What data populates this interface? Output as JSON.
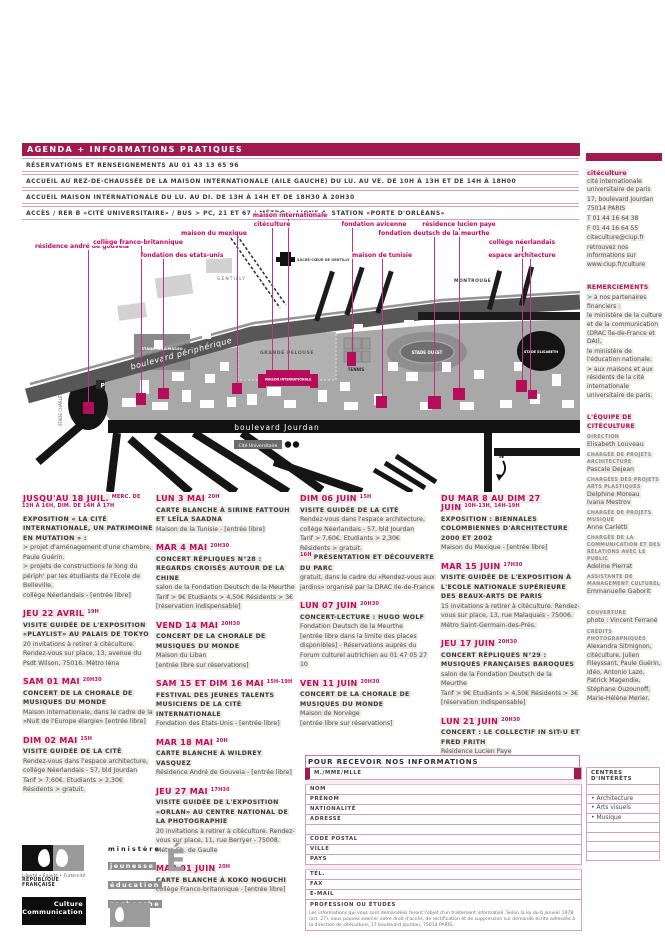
{
  "header": {
    "title": "AGENDA + INFORMATIONS PRATIQUES",
    "info_lines": [
      "RÉSERVATIONS ET RENSEIGNEMENTS AU 01 43 13 65 96",
      "ACCUEIL AU REZ-DE-CHAUSSÉE DE LA MAISON INTERNATIONALE (AILE GAUCHE) DU LU. AU VE. DE 10H À 13H ET DE 14H À 18H00",
      "ACCUEIL MAISON INTERNATIONALE DU LU. AU DI. DE 13H À 14H ET DE 18H30 À 20H30",
      "ACCÈS / RER B «CITÉ UNIVERSITAIRE» / BUS > PC, 21 ET 67 / MÉTRO > LIGNE 4, STATION «PORTE D'ORLÉANS»"
    ]
  },
  "map": {
    "labels": [
      "résidence andré de gouveia",
      "collège franco-britannique",
      "fondation des etats-unis",
      "maison du mexique",
      "maison internationale",
      "citéculture",
      "fondation avicenne",
      "fondation deutsch de la meurthe",
      "résidence lucien paye",
      "maison de tunisie",
      "collège néerlandais",
      "espace architecture"
    ],
    "roads": {
      "peripherique": "boulevard périphérique",
      "jourdan": "boulevard Jourdan"
    },
    "places": {
      "gentilly": "GENTILLY",
      "montrouge": "MONTROUGE",
      "sacre_coeur": "SACRÉ-CŒUR DE GENTILLY",
      "grande_pelouse": "GRANDE PELOUSE",
      "tennis": "TENNIS",
      "stade_ouest": "STADE OUEST",
      "stade_elisabeth": "STADE ELISABETH",
      "stade_chalmasso": "STADE CHALMASSO",
      "stade_charlety": "STADE CHARLÉTY",
      "cite_universitaire": "Cité Universitaire",
      "maison_internationale": "MAISON INTERNATIONALE",
      "parking": "P",
      "north": "N"
    }
  },
  "events": {
    "columns": [
      [
        {
          "date": "JUSQU'AU 18 JUIL.",
          "time": "MERC. DE 13H À 16H, DIM. DE 14H À 17H",
          "lines": [
            {
              "k": "t",
              "t": "EXPOSITION « LA CITÉ INTERNATIONALE, UN PATRIMOINE EN MUTATION » :"
            },
            {
              "k": "b",
              "t": "> projet d'aménagement d'une chambre, Paule Guérin."
            },
            {
              "k": "b",
              "t": "> projets de constructions le long du périph' par les étudiants de l'Ecole de Belleville."
            },
            {
              "k": "b",
              "t": "collège Néerlandais - [entrée libre]"
            }
          ]
        },
        {
          "date": "JEU 22 AVRIL",
          "time": "19H",
          "lines": [
            {
              "k": "t",
              "t": "VISITE GUIDÉE DE L'EXPOSITION «PLAYLIST» AU PALAIS DE TOKYO"
            },
            {
              "k": "b",
              "t": "20 invitations à retirer à citéculture. Rendez-vous sur place, 13, avenue du Psdt Wilson, 75016. Métro Iéna"
            }
          ]
        },
        {
          "date": "SAM 01 MAI",
          "time": "20H30",
          "lines": [
            {
              "k": "t",
              "t": "CONCERT DE LA CHORALE DE MUSIQUES DU MONDE"
            },
            {
              "k": "b",
              "t": "Maison internationale, dans le cadre de la «Nuit de l'Europe élargie» [entrée libre]"
            }
          ]
        },
        {
          "date": "DIM 02 MAI",
          "time": "15H",
          "lines": [
            {
              "k": "t",
              "t": "VISITE GUIDÉE DE LA CITÉ"
            },
            {
              "k": "b",
              "t": "Rendez-vous dans l'espace architecture, collège Néerlandais - 57, bld Jourdan"
            },
            {
              "k": "b",
              "t": "Tarif > 7,60€. Etudiants > 2,30€"
            },
            {
              "k": "b",
              "t": "Résidents > gratuit."
            }
          ]
        }
      ],
      [
        {
          "date": "LUN 3 MAI",
          "time": "20H",
          "lines": [
            {
              "k": "t",
              "t": "CARTE BLANCHE À SIRINE FATTOUH ET LEÏLA SAADNA"
            },
            {
              "k": "b",
              "t": "Maison de la Tunisie - [entrée libre]"
            }
          ]
        },
        {
          "date": "MAR 4 MAI",
          "time": "20H30",
          "lines": [
            {
              "k": "t",
              "t": "CONCERT RÉPLIQUES N°28 : REGARDS CROISÉS AUTOUR DE LA CHINE"
            },
            {
              "k": "b",
              "t": "salon de la Fondation Deutsch de la Meurthe"
            },
            {
              "k": "b",
              "t": "Tarif > 9€ Etudiants > 4,50€ Résidents > 3€"
            },
            {
              "k": "b",
              "t": "[réservation indispensable]"
            }
          ]
        },
        {
          "date": "VEND 14 MAI",
          "time": "20H30",
          "lines": [
            {
              "k": "t",
              "t": "CONCERT DE LA CHORALE DE MUSIQUES DU MONDE"
            },
            {
              "k": "b",
              "t": "Maison du Liban"
            },
            {
              "k": "b",
              "t": "[entrée libre sur réservations]"
            }
          ]
        },
        {
          "date": "SAM 15 ET DIM 16 MAI",
          "time": "15H-19H",
          "lines": [
            {
              "k": "t",
              "t": "FESTIVAL DES JEUNES TALENTS MUSICIENS DE LA CITÉ INTERNATIONALE"
            },
            {
              "k": "b",
              "t": "Fondation des Etats-Unis - [entrée libre]"
            }
          ]
        },
        {
          "date": "MAR 18 MAI",
          "time": "20H",
          "lines": [
            {
              "k": "t",
              "t": "CARTE BLANCHE À WILDREY VASQUEZ"
            },
            {
              "k": "b",
              "t": "Résidence André de Gouveia - [entrée libre]"
            }
          ]
        },
        {
          "date": "JEU 27 MAI",
          "time": "17H30",
          "lines": [
            {
              "k": "t",
              "t": "VISITE GUIDÉE DE L'EXPOSITION «ORLAN» AU CENTRE NATIONAL DE LA PHOTOGRAPHIE"
            },
            {
              "k": "b",
              "t": "20 invitations à retirer à citéculture. Rendez-vous sur place, 11, rue Berryer - 75008. Métro Ch. de Gaulle"
            }
          ]
        },
        {
          "date": "MAR 01 JUIN",
          "time": "20H",
          "lines": [
            {
              "k": "t",
              "t": "CARTE BLANCHE À KOKO NOGUCHI"
            },
            {
              "k": "b",
              "t": "collège Franco-britannique - [entrée libre]"
            }
          ]
        }
      ],
      [
        {
          "date": "DIM 06 JUIN",
          "time": "15H",
          "lines": [
            {
              "k": "t",
              "t": "VISITE GUIDÉE DE LA CITÉ"
            },
            {
              "k": "b",
              "t": "Rendez-vous dans l'espace architecture, collège Néerlandais - 57, bld Jourdan"
            },
            {
              "k": "b",
              "t": "Tarif > 7,60€. Etudiants > 2,30€"
            },
            {
              "k": "b",
              "t": "Résidents > gratuit."
            },
            {
              "k": "t",
              "sup": "16H",
              "t": "PRÉSENTATION ET DÉCOUVERTE DU PARC"
            },
            {
              "k": "b",
              "t": "gratuit, dans le cadre du «Rendez-vous aux jardins» organisé par la DRAC Ile-de-France"
            }
          ]
        },
        {
          "date": "LUN 07 JUIN",
          "time": "20H30",
          "lines": [
            {
              "k": "t",
              "t": "CONCERT-LECTURE : HUGO WOLF"
            },
            {
              "k": "b",
              "t": "Fondation Deutsch de la Meurthe"
            },
            {
              "k": "b",
              "t": "[entrée libre dans la limite des places disponibles] - Réservations auprès du Forum culturel autrichien au 01 47 05 27 10"
            }
          ]
        },
        {
          "date": "VEN 11 JUIN",
          "time": "20H30",
          "lines": [
            {
              "k": "t",
              "t": "CONCERT DE LA CHORALE DE MUSIQUES DU MONDE"
            },
            {
              "k": "b",
              "t": "Maison de Norvège"
            },
            {
              "k": "b",
              "t": "[entrée libre sur réservations]"
            }
          ]
        }
      ],
      [
        {
          "date": "DU MAR 8 AU DIM 27 JUIN",
          "time": "10H-13H, 14H-19H",
          "lines": [
            {
              "k": "t",
              "t": "EXPOSITION : BIENNALES COLOMBIENNES D'ARCHITECTURE 2000 ET 2002"
            },
            {
              "k": "b",
              "t": "Maison du Mexique - [entrée libre]"
            }
          ]
        },
        {
          "date": "MAR 15 JUIN",
          "time": "17H30",
          "lines": [
            {
              "k": "t",
              "t": "VISITE GUIDÉE DE L'EXPOSITION À L'ECOLE NATIONALE SUPÉRIEURE DES BEAUX-ARTS DE PARIS"
            },
            {
              "k": "b",
              "t": "15 invitations à retirer à citéculture. Rendez-vous sur place, 13, rue Malaquais - 75006. Métro Saint-Germain-des-Prés."
            }
          ]
        },
        {
          "date": "JEU 17 JUIN",
          "time": "20H30",
          "lines": [
            {
              "k": "t",
              "t": "CONCERT RÉPLIQUES N°29 : MUSIQUES FRANÇAISES BAROQUES"
            },
            {
              "k": "b",
              "t": "salon de la Fondation Deutsch de la Meurthe"
            },
            {
              "k": "b",
              "t": "Tarif > 9€ Etudiants > 4,50€ Résidents > 3€"
            },
            {
              "k": "b",
              "t": "[réservation indispensable]"
            }
          ]
        },
        {
          "date": "LUN 21 JUIN",
          "time": "20H30",
          "lines": [
            {
              "k": "t",
              "t": "CONCERT : LE COLLECTIF IN SIT-U ET FRED FRITH"
            },
            {
              "k": "b",
              "t": "Résidence Lucien Paye"
            },
            {
              "k": "b",
              "t": "[entrée libre]"
            }
          ]
        }
      ]
    ]
  },
  "sidebar": {
    "blocks": [
      {
        "head": null,
        "lines": [
          {
            "s": "brand",
            "t": "citéculture"
          },
          {
            "s": "text",
            "t": "cité internationale universitaire de paris"
          },
          {
            "s": "text",
            "t": "17, boulevard Jourdan"
          },
          {
            "s": "text",
            "t": "75014 PARIS"
          },
          {
            "s": "text",
            "t": "T 01 44 16 64 38"
          },
          {
            "s": "text",
            "t": "F 01 44 16 64 55"
          },
          {
            "s": "text",
            "t": "citeculture@ciup.fr"
          },
          {
            "s": "text",
            "t": "retrouvez nos informations sur www.ciup.fr/culture"
          }
        ]
      },
      {
        "head": "REMERCIEMENTS",
        "lines": [
          {
            "s": "text",
            "t": "> à nos partenaires financiers :"
          },
          {
            "s": "text",
            "t": "le ministère de la culture et de la communication (DRAC île-de-France et DAI),"
          },
          {
            "s": "text",
            "t": "le ministère de l'éducation nationale."
          },
          {
            "s": "text",
            "t": "> aux maisons et aux résidents de la cité internationale universitaire de paris."
          }
        ]
      },
      {
        "head": "L'ÉQUIPE DE CITÉCULTURE",
        "lines": [
          {
            "s": "role",
            "t": "DIRECTION"
          },
          {
            "s": "name",
            "t": "Elisabeth Louveau"
          },
          {
            "s": "role",
            "t": "CHARGÉE DE PROJETS ARCHITECTURE"
          },
          {
            "s": "name",
            "t": "Pascale Dejean"
          },
          {
            "s": "role",
            "t": "CHARGÉES DES PROJETS ARTS PLASTIQUES"
          },
          {
            "s": "name",
            "t": "Delphine Moreau"
          },
          {
            "s": "name",
            "t": "Ivana Mestrov"
          },
          {
            "s": "role",
            "t": "CHARGÉE DE PROJETS MUSIQUE"
          },
          {
            "s": "name",
            "t": "Anne Carletti"
          },
          {
            "s": "role",
            "t": "CHARGÉE DE LA COMMUNICATION ET DES RELATIONS AVEC LE PUBLIC"
          },
          {
            "s": "name",
            "t": "Adeline Pierrat"
          },
          {
            "s": "role",
            "t": "ASSISTANTE DE MANAGEMENT CULTUREL"
          },
          {
            "s": "name",
            "t": "Emmanuelle Gaborit"
          }
        ]
      },
      {
        "head": null,
        "lines": [
          {
            "s": "role",
            "t": "COUVERTURE"
          },
          {
            "s": "text",
            "t": "photo : Vincent Ferrané"
          },
          {
            "s": "role",
            "t": "CRÉDITS PHOTOGRAPHIQUES"
          },
          {
            "s": "text",
            "t": "Alexandra Sitmignon, citéculture, Julien Fileyssant, Paule Guérin, Idéo, Antonio Lazo, Patrick Magendie, Stéphane Ouzounoff, Marie-Hélène Merier."
          }
        ]
      }
    ]
  },
  "form": {
    "title": "POUR RECEVOIR NOS INFORMATIONS",
    "fields": [
      "M./MME/MLLE",
      "NOM",
      "PRÉNOM",
      "NATIONALITÉ",
      "ADRESSE",
      "CODE POSTAL",
      "VILLE",
      "PAYS",
      "TÉL.",
      "FAX",
      "E-MAIL",
      "PROFESSION OU ÉTUDES"
    ],
    "centres": {
      "title": "CENTRES D'INTÉRÊTS",
      "bullet": "•",
      "items": [
        "Architecture",
        "Arts visuels",
        "Musique"
      ]
    },
    "legal": "Les informations qui vous sont demandées feront l'objet d'un traitement informatisé. Selon la loi du 6 janvier 1978 (art. 27), vous pouvez exercer votre droit d'accès, de rectification et de suppression sur demande écrite adressée à la direction de citéculture, 17 boulevard Jourdan, 75014 PARIS."
  },
  "logos": {
    "rf_motto": "Liberté • Égalité • Fraternité",
    "rf_name": "RÉPUBLIQUE FRANÇAISE",
    "mjer_l1": "ministère",
    "mjer_l2": "jeunesse",
    "mjer_l3": "éducation",
    "mjer_l4": "recherche",
    "mjer_e": "É",
    "culture_l1": "Culture",
    "culture_l2": "Communication"
  },
  "colors": {
    "bar_magenta": "#a01a50",
    "accent_magenta": "#c20a5c",
    "building_magenta": "#b50d5a",
    "map_gray": "#a8a8a8"
  }
}
